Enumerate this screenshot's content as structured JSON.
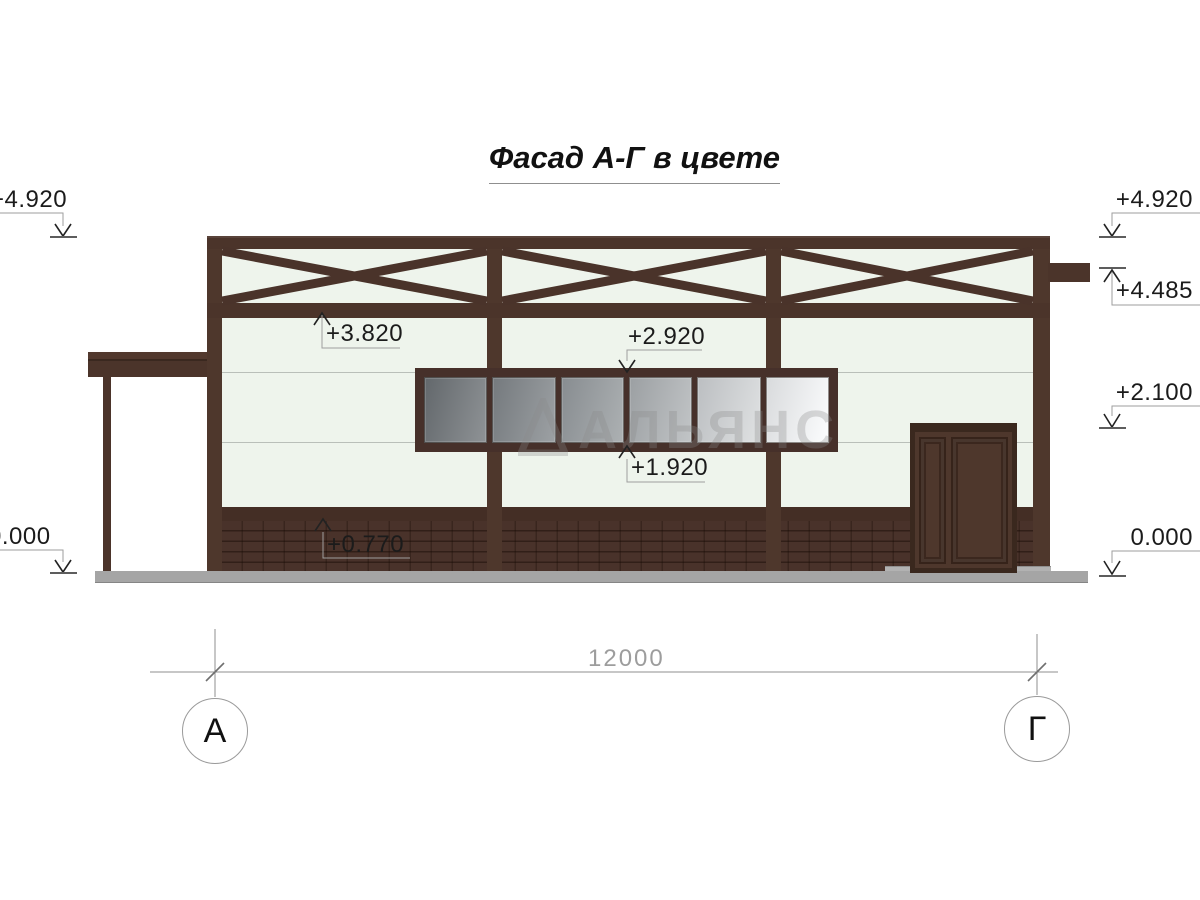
{
  "title": "Фасад А-Г в цвете",
  "watermark_text": "АЛЬЯНС",
  "axes": {
    "left_label": "А",
    "right_label": "Г"
  },
  "dimension": {
    "overall_width": "12000"
  },
  "elevations": {
    "left_roof": "+4.920",
    "left_ground": "0.000",
    "right_roof": "+4.920",
    "right_truss": "+4.485",
    "right_midwall": "+2.100",
    "right_ground": "0.000",
    "truss_bottom_chord": "+3.820",
    "window_head": "+2.920",
    "window_sill": "+1.920",
    "plinth_top": "+0.770"
  },
  "colors": {
    "frame_brown": "#4b342a",
    "brick_dark": "#49322a",
    "wall_mint": "#eef4ec",
    "glass_dark": "#62676b",
    "glass_light": "#fcfdfe",
    "ground_gray": "#a5a5a5",
    "leader_gray": "#9e9e9e",
    "dim_text_gray": "#9d9d9d"
  }
}
